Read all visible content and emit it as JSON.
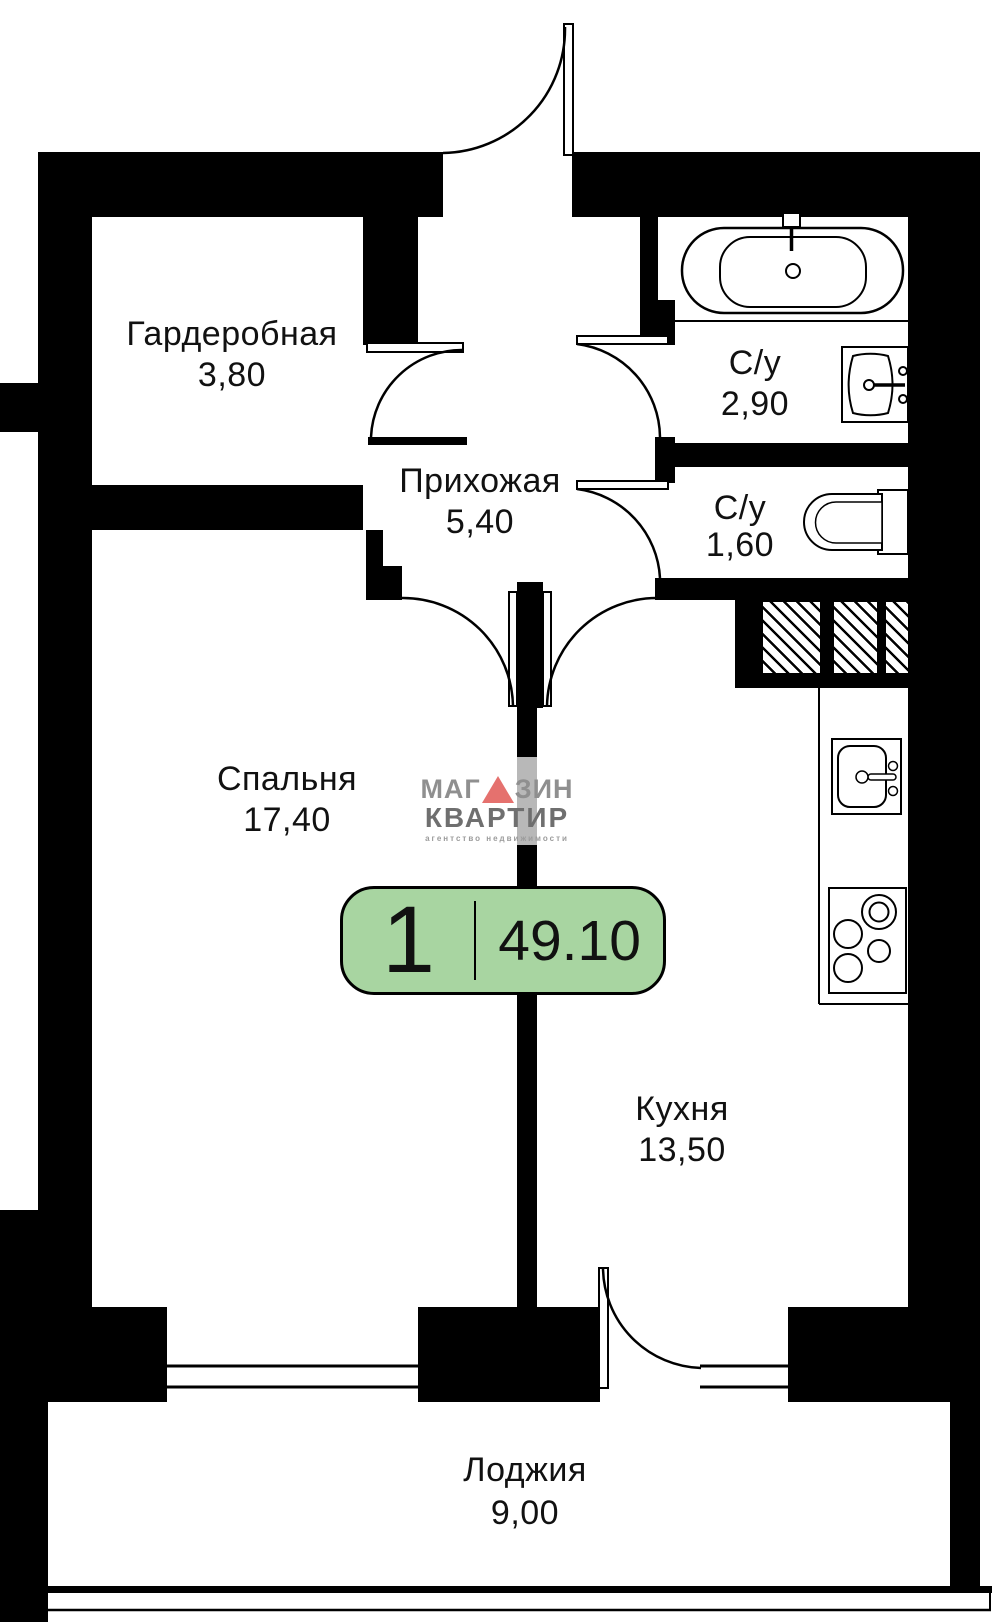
{
  "floorplan": {
    "badge": {
      "rooms_count": "1",
      "total_area": "49.10"
    },
    "rooms": [
      {
        "name": "Гардеробная",
        "area": "3,80"
      },
      {
        "name": "Прихожая",
        "area": "5,40"
      },
      {
        "name": "С/у",
        "area": "2,90"
      },
      {
        "name": "С/у",
        "area": "1,60"
      },
      {
        "name": "Спальня",
        "area": "17,40"
      },
      {
        "name": "Кухня",
        "area": "13,50"
      },
      {
        "name": "Лоджия",
        "area": "9,00"
      }
    ],
    "logo": {
      "word1_part1": "МАГ",
      "word1_part2": "ЗИН",
      "word2": "КВАРТИР",
      "tagline": "агентство недвижимости"
    },
    "fixtures": [
      "bathtub-icon",
      "washbasin-icon",
      "toilet-icon",
      "kitchen-sink-icon",
      "stove-icon",
      "vent-shaft-hatch"
    ],
    "colors": {
      "wall": "#000000",
      "badge_green": "#a8d5a1",
      "logo_gray": "#8f8f8f",
      "logo_dark_gray": "#6f6f6f",
      "logo_red": "#e5716e"
    }
  }
}
